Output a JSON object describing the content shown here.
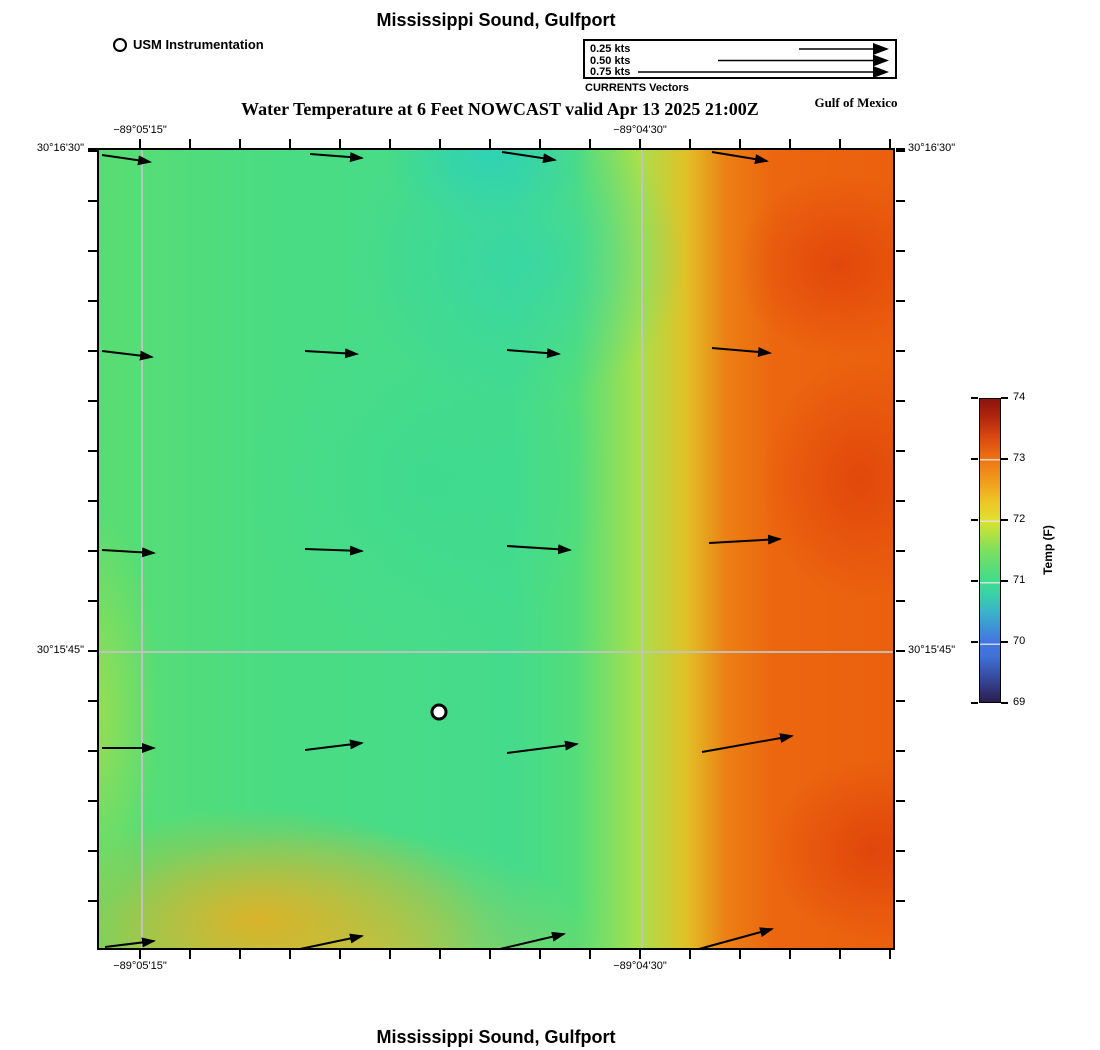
{
  "page": {
    "title_top": "Mississippi Sound, Gulfport",
    "subtitle": "Water Temperature at 6 Feet NOWCAST valid Apr 13 2025 21:00Z",
    "region_label": "Gulf of Mexico",
    "title_bottom": "Mississippi Sound, Gulfport"
  },
  "legend": {
    "station_label": "USM Instrumentation",
    "currents": {
      "title": "CURRENTS Vectors",
      "items": [
        {
          "label": "0.25 kts",
          "length_px": 88
        },
        {
          "label": "0.50 kts",
          "length_px": 169
        },
        {
          "label": "0.75 kts",
          "length_px": 249
        }
      ]
    }
  },
  "axes": {
    "lat_north": "30°16'30\"",
    "lat_mid": "30°15'45\"",
    "lon_west": "−89°05'15\"",
    "lon_east": "−89°04'30\""
  },
  "colorbar": {
    "title": "Temp (F)",
    "min": 69,
    "max": 74,
    "tick_labels": [
      "74",
      "73",
      "72",
      "71",
      "70",
      "69"
    ],
    "key_colors": {
      "69": "#2a1d50",
      "70": "#4276e0",
      "71": "#40dc8b",
      "72": "#dfe032",
      "73": "#ee7513",
      "74": "#8c140c"
    }
  },
  "chart_data": {
    "type": "heatmap",
    "title": "Mississippi Sound, Gulfport",
    "subtitle": "Water Temperature at 6 Feet NOWCAST valid Apr 13 2025 21:00Z",
    "variable": "Water Temperature at 6 Feet (F)",
    "valid_time": "Apr 13 2025 21:00Z",
    "x_ticks": [
      "−89°05'15\"",
      "−89°04'30\""
    ],
    "y_ticks": [
      "30°16'30\"",
      "30°15'45\""
    ],
    "colorbar_range": [
      69,
      74
    ],
    "temperature_grid_f_north_to_south_west_to_east": [
      [
        71.1,
        70.9,
        70.6,
        72.2,
        73.3
      ],
      [
        71.1,
        70.9,
        70.8,
        72.6,
        73.5
      ],
      [
        71.1,
        71.0,
        71.0,
        72.8,
        73.4
      ],
      [
        71.3,
        71.1,
        71.1,
        72.7,
        73.5
      ],
      [
        72.2,
        72.4,
        71.2,
        72.1,
        73.1
      ]
    ],
    "vector_scale_px_per_kt": 352,
    "vectors": [
      {
        "x": 3,
        "y": 5,
        "dx": 48,
        "dy": 7,
        "speed_kts": 0.14
      },
      {
        "x": 211,
        "y": 4,
        "dx": 52,
        "dy": 4,
        "speed_kts": 0.15
      },
      {
        "x": 403,
        "y": 2,
        "dx": 53,
        "dy": 8,
        "speed_kts": 0.15
      },
      {
        "x": 613,
        "y": 2,
        "dx": 55,
        "dy": 9,
        "speed_kts": 0.16
      },
      {
        "x": 3,
        "y": 201,
        "dx": 50,
        "dy": 6,
        "speed_kts": 0.14
      },
      {
        "x": 206,
        "y": 201,
        "dx": 52,
        "dy": 3,
        "speed_kts": 0.15
      },
      {
        "x": 408,
        "y": 200,
        "dx": 52,
        "dy": 4,
        "speed_kts": 0.15
      },
      {
        "x": 613,
        "y": 198,
        "dx": 58,
        "dy": 5,
        "speed_kts": 0.17
      },
      {
        "x": 3,
        "y": 400,
        "dx": 52,
        "dy": 3,
        "speed_kts": 0.15
      },
      {
        "x": 206,
        "y": 399,
        "dx": 57,
        "dy": 2,
        "speed_kts": 0.16
      },
      {
        "x": 408,
        "y": 396,
        "dx": 63,
        "dy": 4,
        "speed_kts": 0.18
      },
      {
        "x": 610,
        "y": 393,
        "dx": 71,
        "dy": -4,
        "speed_kts": 0.2
      },
      {
        "x": 3,
        "y": 598,
        "dx": 52,
        "dy": 0,
        "speed_kts": 0.15
      },
      {
        "x": 206,
        "y": 600,
        "dx": 57,
        "dy": -7,
        "speed_kts": 0.16
      },
      {
        "x": 408,
        "y": 603,
        "dx": 70,
        "dy": -9,
        "speed_kts": 0.2
      },
      {
        "x": 603,
        "y": 602,
        "dx": 90,
        "dy": -16,
        "speed_kts": 0.26
      },
      {
        "x": 6,
        "y": 797,
        "dx": 49,
        "dy": -6,
        "speed_kts": 0.14
      },
      {
        "x": 201,
        "y": 799,
        "dx": 62,
        "dy": -13,
        "speed_kts": 0.18
      },
      {
        "x": 401,
        "y": 799,
        "dx": 64,
        "dy": -15,
        "speed_kts": 0.19
      },
      {
        "x": 600,
        "y": 799,
        "dx": 73,
        "dy": -20,
        "speed_kts": 0.22
      }
    ],
    "station_marker": {
      "x": 340,
      "y": 562,
      "label": "USM Instrumentation"
    }
  }
}
